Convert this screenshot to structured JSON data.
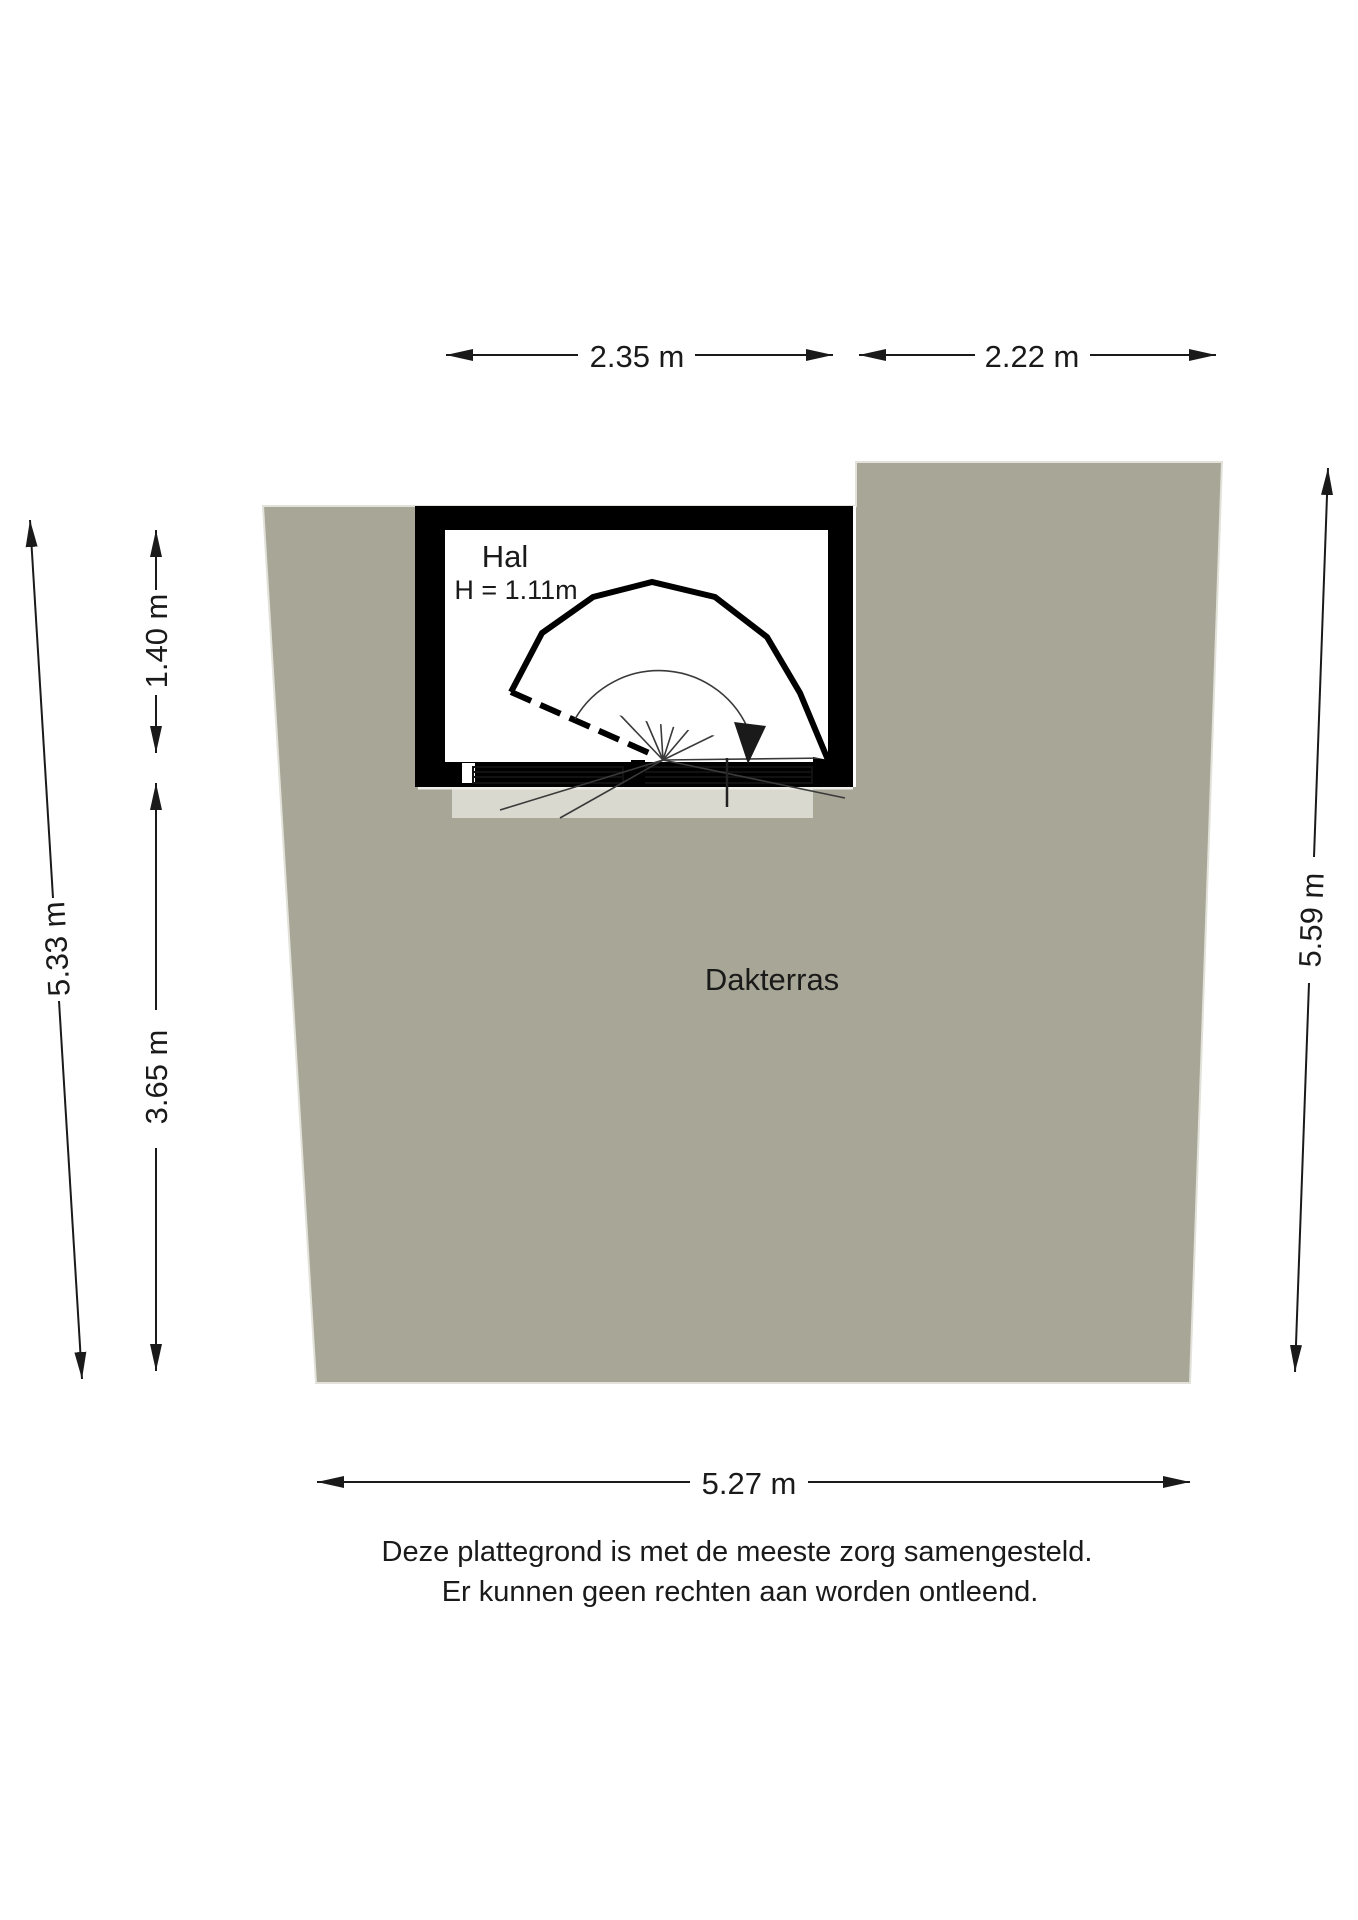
{
  "floorplan": {
    "title": "Dakterras plattegrond",
    "rooms": {
      "hal": {
        "label": "Hal",
        "height_label": "H = 1.11m"
      },
      "dakterras": {
        "label": "Dakterras"
      }
    },
    "dimensions": {
      "top_left": "2.35 m",
      "top_right": "2.22 m",
      "left_upper": "1.40 m",
      "left_lower": "3.65 m",
      "left_outer": "5.33 m",
      "right_side": "5.59 m",
      "bottom": "5.27 m"
    },
    "disclaimer": [
      "Deze plattegrond is met de meeste zorg samengesteld.",
      "Er kunnen geen rechten aan worden ontleend."
    ],
    "colors": {
      "background": "#ffffff",
      "terrace_fill": "#a8a797",
      "terrace_edge": "#e2e2da",
      "wall": "#000000",
      "ink": "#1a1a1a"
    }
  }
}
